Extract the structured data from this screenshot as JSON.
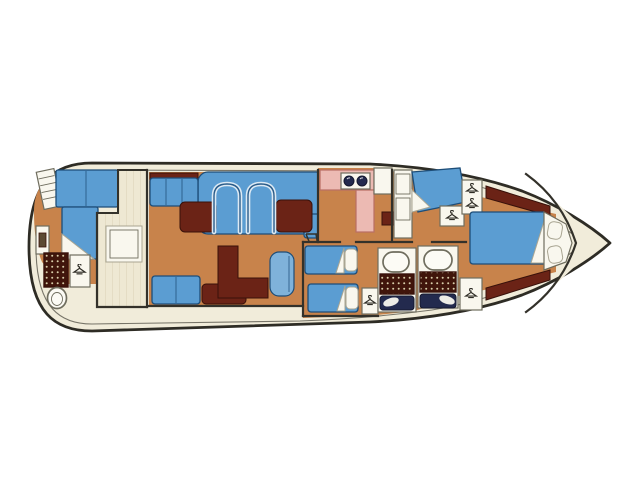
{
  "figure": {
    "kind": "motor-yacht interior floor plan",
    "view": "top-down deck plan",
    "orientation": "bow-right, stern-left",
    "text_content": "none (drawing contains no readable text)"
  },
  "palette": {
    "page_bg": "#ffffff",
    "hull_cream": "#f1ecda",
    "deck_plank": "#eee8d3",
    "plank_line": "#d9d1b6",
    "floor_orange": "#c8834b",
    "upholstery_blue": "#5b9dd2",
    "upholstery_blue_light": "#7fb2da",
    "upholstery_stroke": "#1d4d78",
    "joinery_maroon": "#6b2316",
    "joinery_stroke": "#38110a",
    "shower_brown": "#40150b",
    "shower_dot": "#d8cda9",
    "galley_pink": "#ecbab3",
    "galley_pink_line": "#b96f63",
    "fixture_white": "#f9f7ee",
    "fixture_stroke": "#6f6d5e",
    "toilet_white": "#fcfbf5",
    "counter_navy": "#232a4e",
    "outline_dark": "#2e2c25",
    "wall_dark": "#33312a",
    "sheer_line": "#777468",
    "arch_light": "#ddeaf4",
    "arch_dark": "#2a5c8a"
  },
  "icons": [
    {
      "name": "hanger-icon",
      "meaning": "hanging locker / wardrobe"
    },
    {
      "name": "burner-icon",
      "meaning": "galley stove burners"
    },
    {
      "name": "steps-icon",
      "meaning": "companionway steps"
    }
  ],
  "rooms": [
    {
      "id": "aft-cabin",
      "name": "aft cabin with L-shaped double berth, shower and toilet"
    },
    {
      "id": "wheelhouse-deck",
      "name": "planked deck area with square table"
    },
    {
      "id": "saloon",
      "name": "saloon with curved dinette settees, tables and helm seat"
    },
    {
      "id": "galley",
      "name": "galley with stove and counters"
    },
    {
      "id": "guest-cabin",
      "name": "guest double cabin with vanity and lockers"
    },
    {
      "id": "twin-cabin",
      "name": "twin-berth cabin"
    },
    {
      "id": "heads",
      "name": "two bathrooms with toilet, shower grid and sink counter"
    },
    {
      "id": "forward-cabin",
      "name": "forward V-berth cabin with shelves and headboard"
    }
  ]
}
